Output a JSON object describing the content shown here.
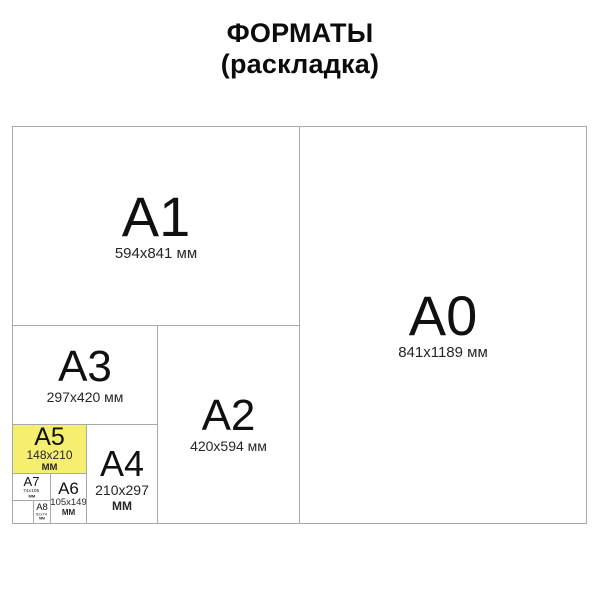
{
  "title": {
    "line1": "ФОРМАТЫ",
    "line2": "(раскладка)"
  },
  "colors": {
    "highlight": "#f6ee70",
    "border": "#a8a8a8",
    "text": "#141414"
  },
  "formats": {
    "a0": {
      "label": "A0",
      "dims": "841x1189 мм"
    },
    "a1": {
      "label": "A1",
      "dims": "594x841 мм"
    },
    "a2": {
      "label": "A2",
      "dims": "420x594 мм"
    },
    "a3": {
      "label": "A3",
      "dims": "297x420 мм"
    },
    "a4": {
      "label": "A4",
      "dims": "210x297",
      "unit": "ММ"
    },
    "a5": {
      "label": "A5",
      "dims": "148x210",
      "unit": "ММ",
      "highlighted": true
    },
    "a6": {
      "label": "A6",
      "dims": "105x149",
      "unit": "ММ"
    },
    "a7": {
      "label": "A7",
      "dims": "74x105",
      "unit": "ММ"
    },
    "a8": {
      "label": "A8",
      "dims": "52x74",
      "unit": "ММ"
    }
  }
}
